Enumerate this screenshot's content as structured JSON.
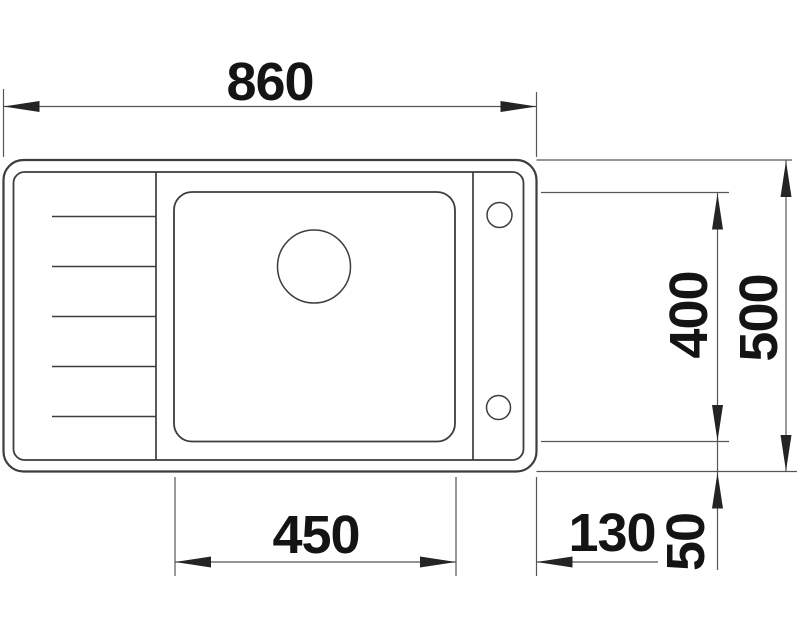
{
  "diagram": {
    "type": "technical-drawing",
    "view": "top-view",
    "subject": "kitchen sink with drainboard, single basin, drain hole and two tap holes",
    "units": "mm",
    "labels": {
      "total_width": "860",
      "basin_width": "450",
      "tap_ledge_width": "130",
      "basin_depth": "400",
      "total_depth": "500",
      "rim_offset": "50"
    }
  },
  "colors": {
    "background": "#ffffff",
    "outline": "#3d3d3d",
    "dimension_line": "#565656",
    "label_text": "#141414"
  }
}
